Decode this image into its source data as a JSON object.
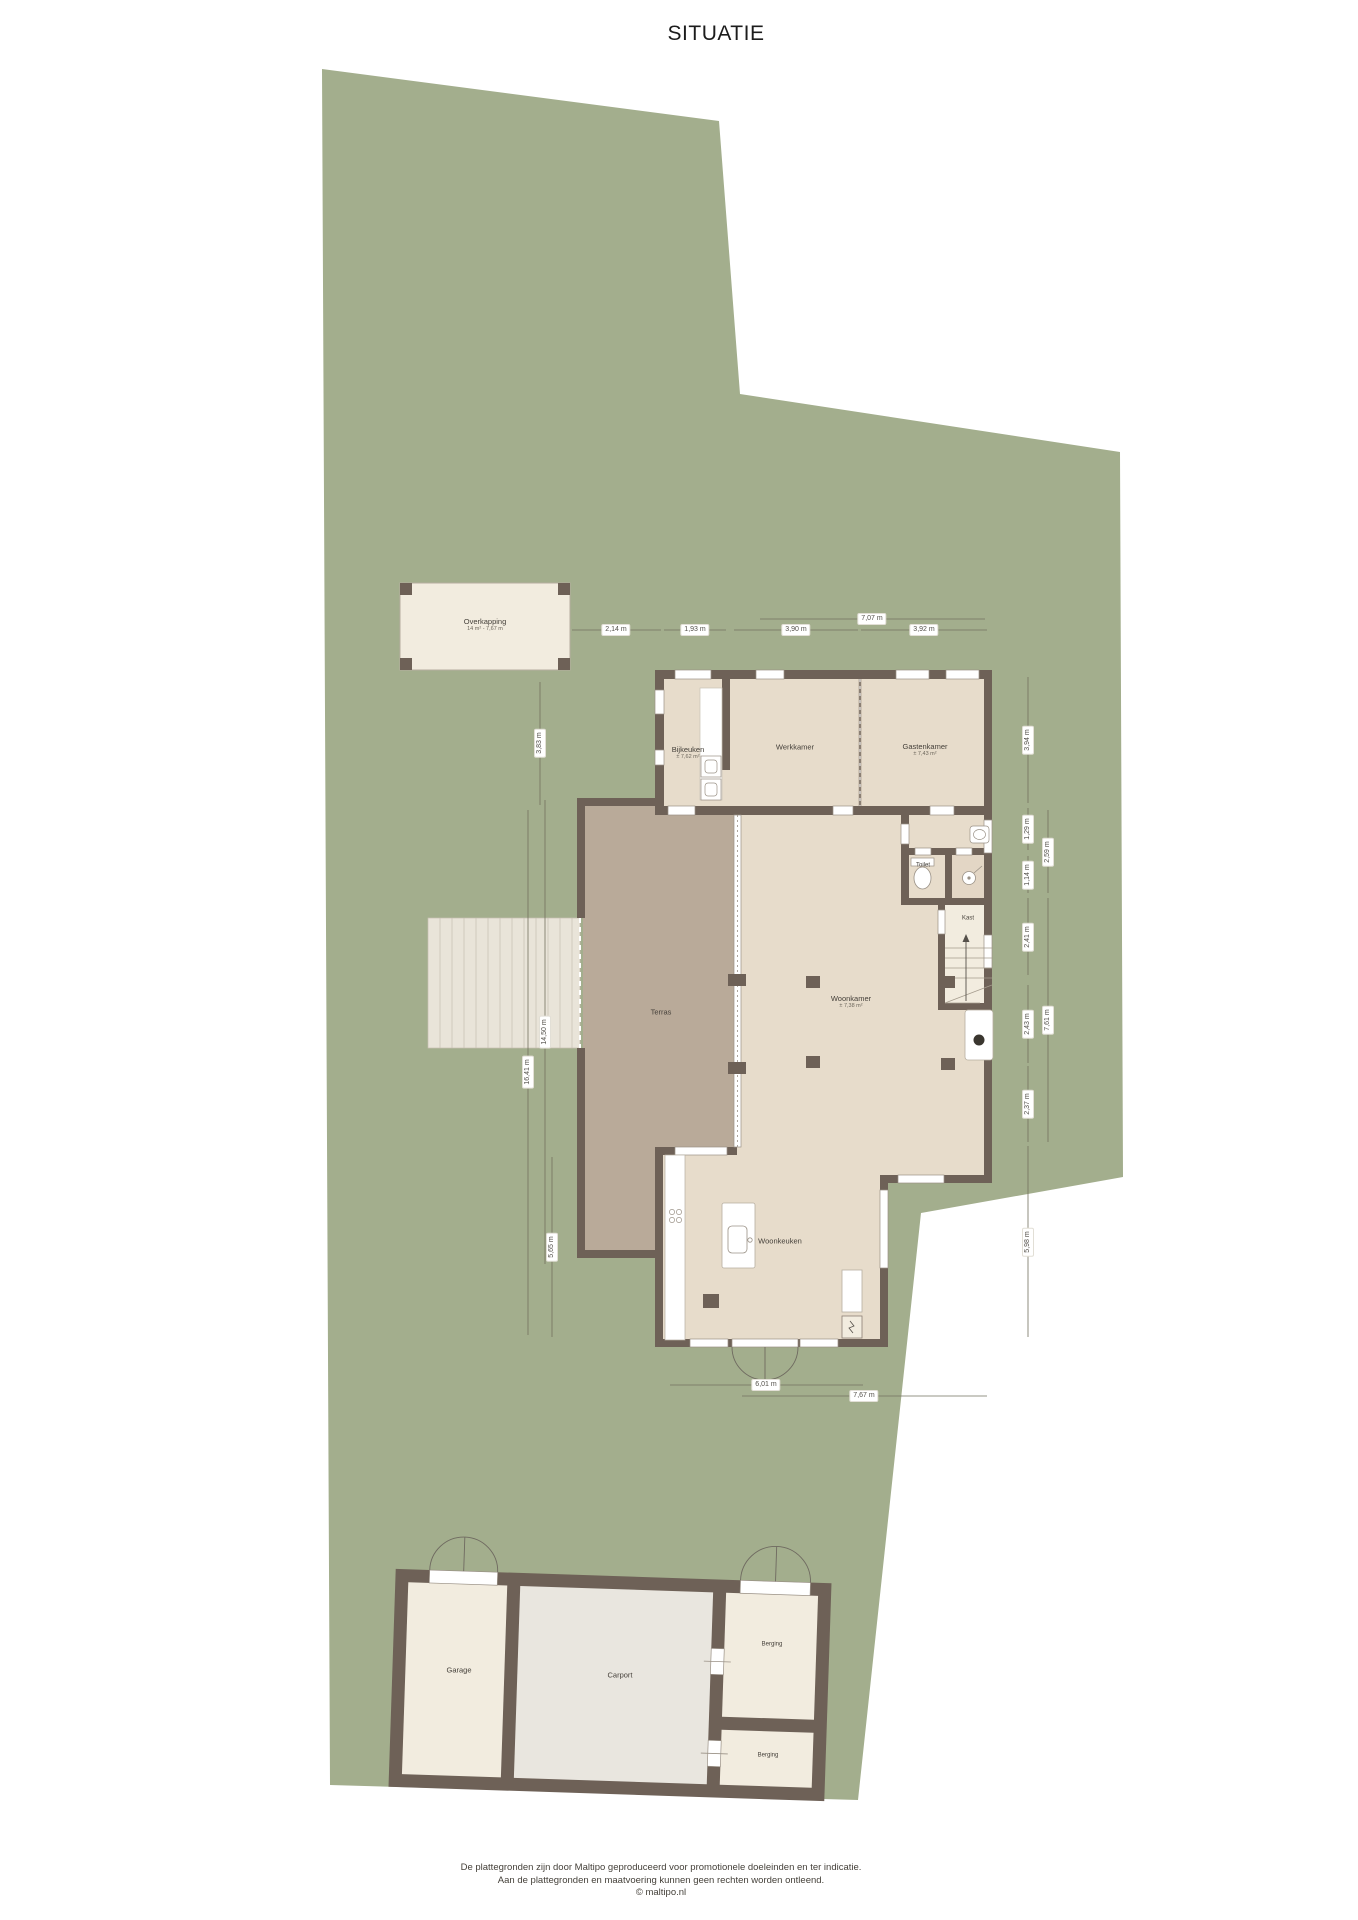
{
  "title": "SITUATIE",
  "plan": {
    "rooms": {
      "overkapping": {
        "label": "Overkapping",
        "sub": "14 m² - 7,67 m"
      },
      "bijkeuken": {
        "label": "Bijkeuken",
        "sub": "± 7,62 m²"
      },
      "werkkamer": {
        "label": "Werkkamer"
      },
      "gastenkamer": {
        "label": "Gastenkamer",
        "sub": "± 7,43 m²"
      },
      "toilet": {
        "label": "Toilet"
      },
      "kast": {
        "label": "Kast"
      },
      "woonkamer": {
        "label": "Woonkamer",
        "sub": "± 7,38 m²"
      },
      "terras": {
        "label": "Terras"
      },
      "woonkeuken": {
        "label": "Woonkeuken"
      },
      "garage": {
        "label": "Garage"
      },
      "carport": {
        "label": "Carport"
      },
      "berging_boven": {
        "label": "Berging"
      },
      "berging_onder": {
        "label": "Berging"
      }
    },
    "dimensions": {
      "top": [
        "7,07 m",
        "2,14 m",
        "1,93 m",
        "3,90 m",
        "3,92 m"
      ],
      "left": [
        "3,83 m",
        "16,41 m",
        "14,50 m",
        "5,65 m"
      ],
      "right": [
        "3,94 m",
        "1,29 m",
        "2,59 m",
        "1,14 m",
        "2,41 m",
        "2,43 m",
        "7,61 m",
        "2,37 m",
        "5,98 m"
      ],
      "bottom": [
        "6,01 m",
        "7,67 m"
      ]
    }
  },
  "footer": {
    "line1": "De plattegronden zijn door Maltipo geproduceerd voor promotionele doeleinden en ter indicatie.",
    "line2": "Aan de plattegronden en maatvoering kunnen geen rechten worden ontleend.",
    "line3": "© maltipo.nl"
  },
  "colors": {
    "plot_green": "#a3ae8d",
    "wall": "#6e6157",
    "room_fill": "#e7dccb",
    "light_fill": "#f2ecdf",
    "carport_fill": "#e9e6df",
    "terras_fill": "#b9aa99",
    "deck_fill": "#e9e4d9",
    "dimension_text": "#53504a"
  }
}
